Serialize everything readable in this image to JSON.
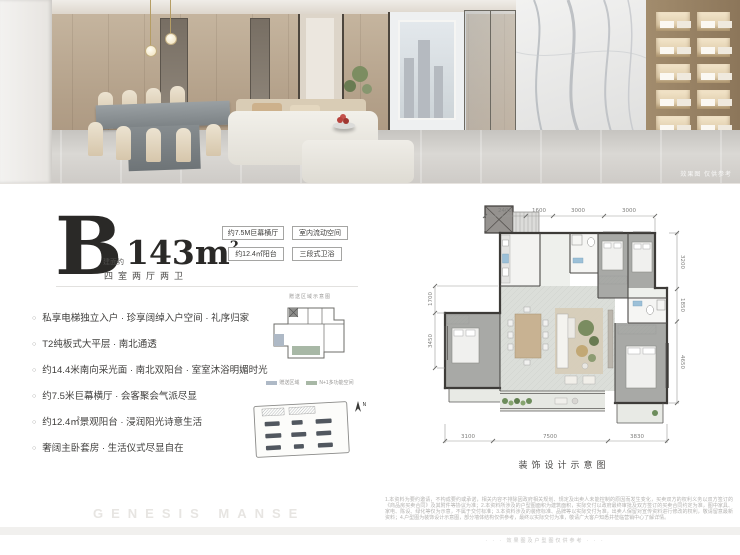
{
  "photo": {
    "caption": "效果图 仅供参考"
  },
  "unit": {
    "letter": "B",
    "area_prefix": "建面约",
    "area_value": "143m",
    "area_sup": "2",
    "layout": "四室两厅两卫"
  },
  "badges": [
    "约7.5M巨幕横厅",
    "室内流动空间",
    "约12.4㎡阳台",
    "三段式卫浴"
  ],
  "features": {
    "items": [
      "私享电梯独立入户 · 珍享阔绰入户空间 · 礼序归家",
      "T2纯板式大平层 · 南北通透",
      "约14.4米南向采光面 · 南北双阳台 · 室室沐浴明媚时光",
      "约7.5米巨幕横厅 · 会客聚会气派尽显",
      "约12.4㎡景观阳台 · 浸润阳光诗意生活",
      "奢阔主卧套房 · 生活仪式尽显自在"
    ]
  },
  "insets": {
    "keyplan_title": "赠送区域示意图",
    "legend": [
      {
        "label": "赠送区域",
        "color": "#aeb9c6"
      },
      {
        "label": "N+1多功能空间",
        "color": "#a8b8a6"
      }
    ],
    "north_label": "N"
  },
  "floorplan": {
    "caption": "装饰设计示意图",
    "dims_top": [
      "2400",
      "1600",
      "3000",
      "3000"
    ],
    "dims_right": [
      "3200",
      "1850",
      "4650"
    ],
    "dims_left": [
      "1700",
      "3450"
    ],
    "dims_bottom": [
      "3100",
      "7500",
      "3830"
    ]
  },
  "footer": {
    "watermark": "GENESIS MANSE",
    "disclaimer": "1.本资料为要约邀请，不构成要约或承诺，相关内容不排除因政府相关规划、规定及出卖人未能控制的原因而发生变化，买卖双方的权利义务以双方签订的《商品房买卖合同》及其附件等协议为准；2.本资料所涉及的户型图面积为建筑面积，实际交付以政府最终审批及双方签订的买卖合同约定为准，图中家具、家电、陈设、绿化等仅为示意，不属于交付标准；3.本资料涉及的装修标准、品牌等以实际交付为准，出卖人保留对宣传资料进行修改的权利，敬请留意最新资料；4.户型图为装饰设计示意图，部分墙体结构仅供参考，最终以实际交付为准，敬请广大客户知悉并莅临营销中心了解详情。",
    "fineprint": "· · · 效果图及户型图仅供参考 · · ·"
  },
  "colors": {
    "legend_blue": "#aeb9c6",
    "legend_green": "#a8b8a6",
    "wall_ink": "#3d3b38",
    "plan_floor": "#dbded9"
  }
}
